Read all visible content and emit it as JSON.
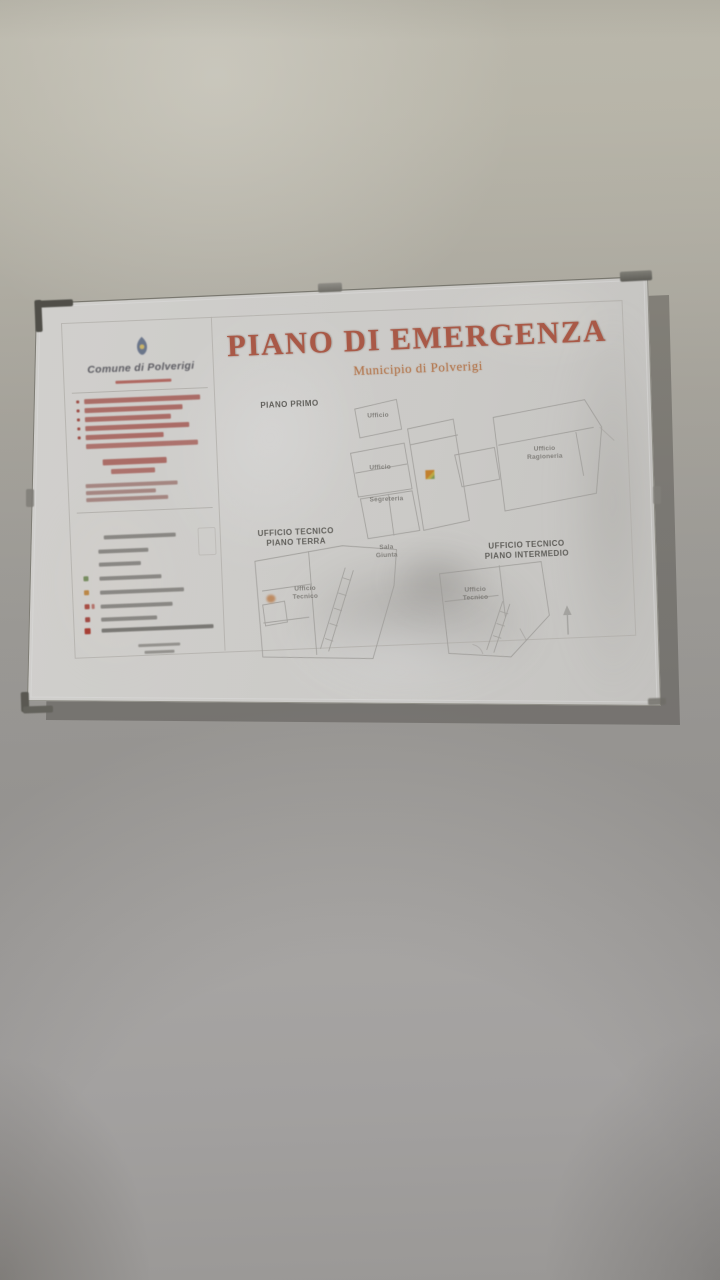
{
  "poster": {
    "title": "PIANO DI EMERGENZA",
    "subtitle": "Municipio di Polverigi",
    "logo": {
      "name": "Comune di Polverigi"
    },
    "plans": [
      {
        "label": "PIANO PRIMO",
        "rooms": [
          "Ufficio",
          "Ufficio",
          "Ufficio Ragioneria",
          "Segreteria"
        ]
      },
      {
        "label_line1": "UFFICIO TECNICO",
        "label_line2": "PIANO TERRA",
        "rooms": [
          "Sala Giunta",
          "Ufficio Tecnico"
        ]
      },
      {
        "label_line1": "UFFICIO TECNICO",
        "label_line2": "PIANO INTERMEDIO",
        "rooms": [
          "Ufficio Tecnico"
        ]
      }
    ],
    "colors": {
      "title": "#c05b45",
      "subtitle": "#cd7f4b",
      "emergency_text": "#b5544c",
      "marker": "#e0912f",
      "legend_green": "#86a06b",
      "legend_orange": "#d79a4e",
      "legend_red": "#c0554a",
      "plan_lines": "#b2b0ab"
    }
  }
}
